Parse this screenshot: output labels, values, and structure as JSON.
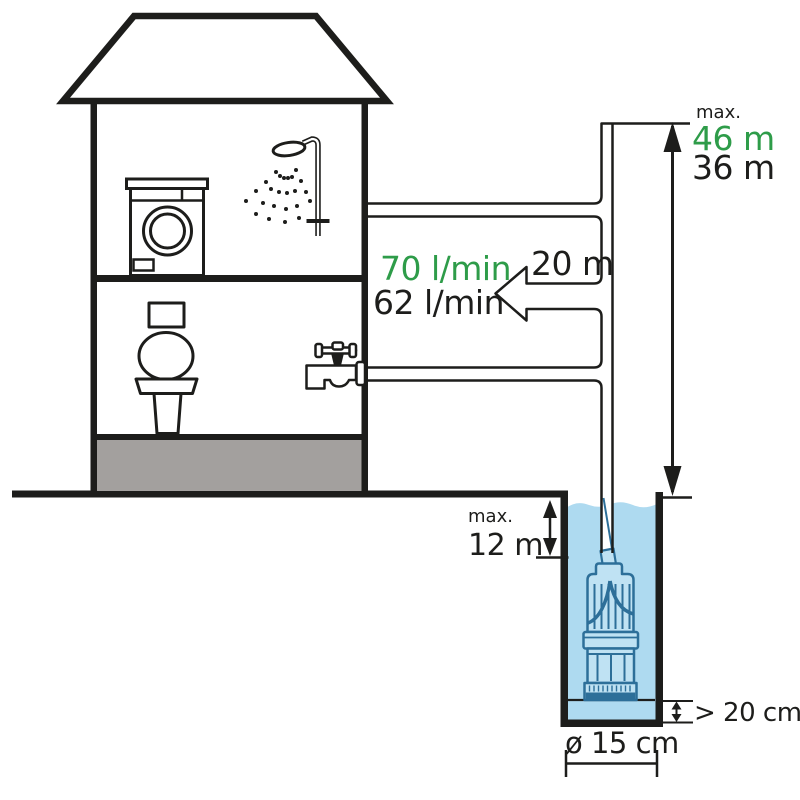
{
  "labels": {
    "delivery_head": {
      "prefix": "max.",
      "primary": "46 m",
      "secondary": "36 m"
    },
    "flow_rate": {
      "primary": "70 l/min",
      "secondary": "62 l/min"
    },
    "pipe_length": {
      "value": "20 m"
    },
    "immersion_depth": {
      "prefix": "max.",
      "value": "12 m"
    },
    "bottom_clearance": {
      "value": "> 20 cm"
    },
    "well_diameter": {
      "value": "ø 15 cm"
    }
  },
  "colors": {
    "accent_green": "#2e9c49",
    "ink": "#1d1d1b",
    "water": "#aedaf0",
    "pump_line": "#2d6f99",
    "pump_fill": "#bfe2f3",
    "foundation": "#a3a09e"
  }
}
